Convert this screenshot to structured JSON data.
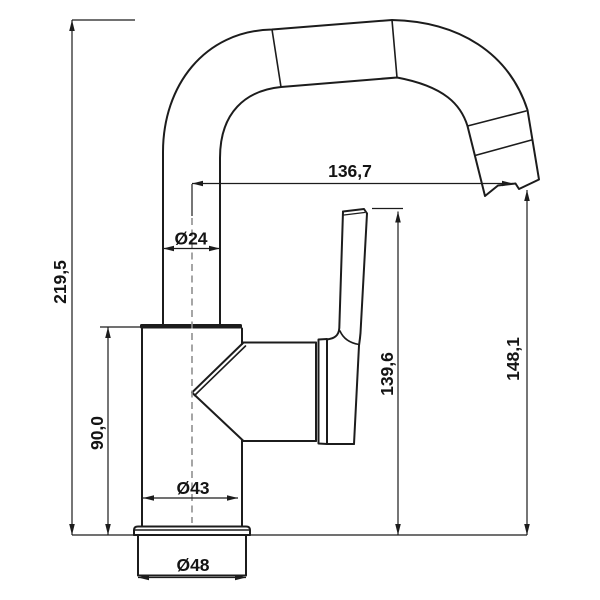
{
  "drawing": {
    "kind": "faucet-dimension-diagram",
    "view": "side-elevation",
    "background": "#ffffff",
    "line_color": "#1c1c1c",
    "centerline_color": "#8f8f8f",
    "dims": {
      "overall_height": {
        "label": "219,5",
        "orientation": "vertical"
      },
      "body_height": {
        "label": "90,0",
        "orientation": "vertical"
      },
      "spout_reach": {
        "label": "136,7",
        "orientation": "horizontal"
      },
      "riser_diameter": {
        "label": "Ø24",
        "orientation": "horizontal"
      },
      "body_diameter": {
        "label": "Ø43",
        "orientation": "horizontal"
      },
      "base_diameter": {
        "label": "Ø48",
        "orientation": "horizontal"
      },
      "handle_top_height": {
        "label": "139,6",
        "orientation": "vertical"
      },
      "outlet_height": {
        "label": "148,1",
        "orientation": "vertical"
      }
    }
  }
}
